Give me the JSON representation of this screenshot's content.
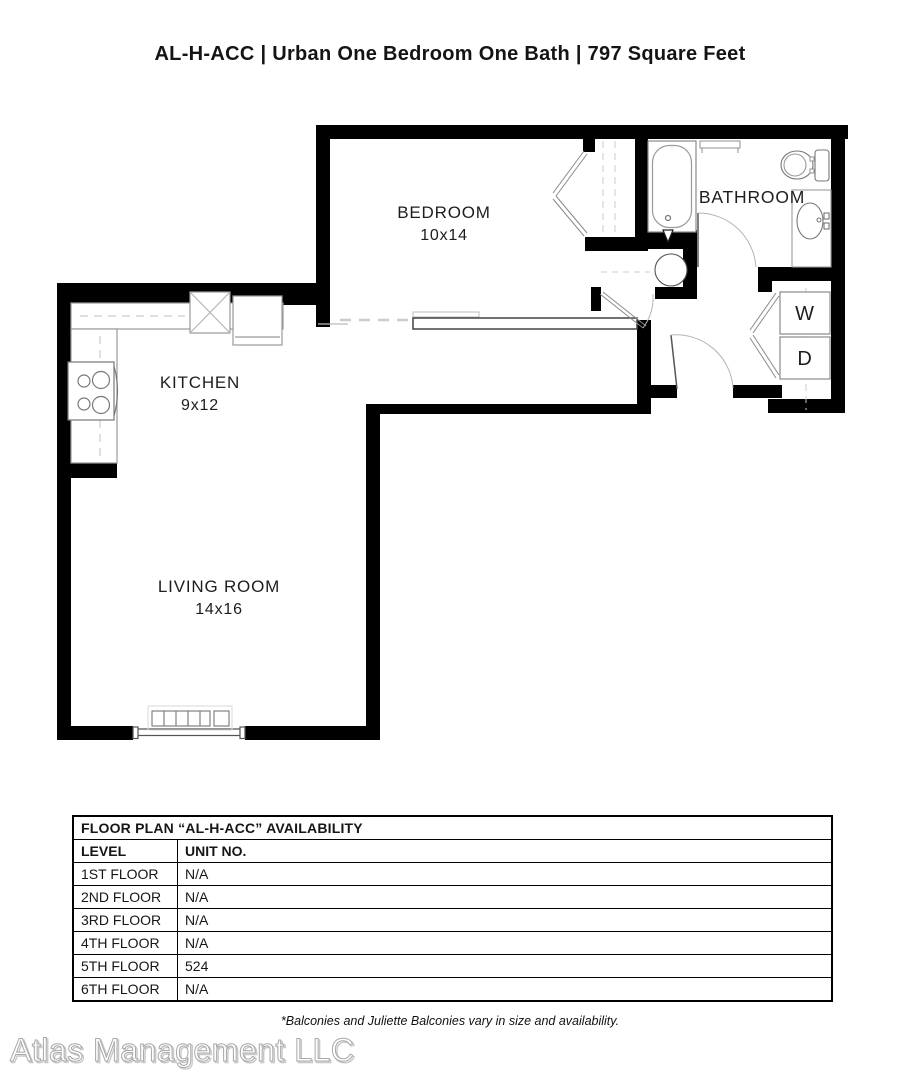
{
  "title": "AL-H-ACC | Urban One Bedroom One Bath | 797 Square Feet",
  "floorplan": {
    "rooms": [
      {
        "name": "BEDROOM",
        "dims": "10x14"
      },
      {
        "name": "KITCHEN",
        "dims": "9x12"
      },
      {
        "name": "LIVING ROOM",
        "dims": "14x16"
      },
      {
        "name": "BATHROOM",
        "dims": ""
      }
    ],
    "appliances": {
      "washer_label": "W",
      "dryer_label": "D"
    }
  },
  "availability": {
    "title": "FLOOR PLAN “AL-H-ACC” AVAILABILITY",
    "columns": [
      "LEVEL",
      "UNIT NO."
    ],
    "rows": [
      {
        "level": "1ST FLOOR",
        "unit": "N/A"
      },
      {
        "level": "2ND FLOOR",
        "unit": "N/A"
      },
      {
        "level": "3RD FLOOR",
        "unit": "N/A"
      },
      {
        "level": "4TH FLOOR",
        "unit": "N/A"
      },
      {
        "level": "5TH FLOOR",
        "unit": "524"
      },
      {
        "level": "6TH FLOOR",
        "unit": "N/A"
      }
    ]
  },
  "footnote": "*Balconies and Juliette Balconies vary in size and availability.",
  "watermark": "Atlas Management LLC",
  "colors": {
    "wall": "#000000",
    "fixture": "#8a8a8a",
    "dash": "#cccccc",
    "label": "#1d1d1d"
  }
}
